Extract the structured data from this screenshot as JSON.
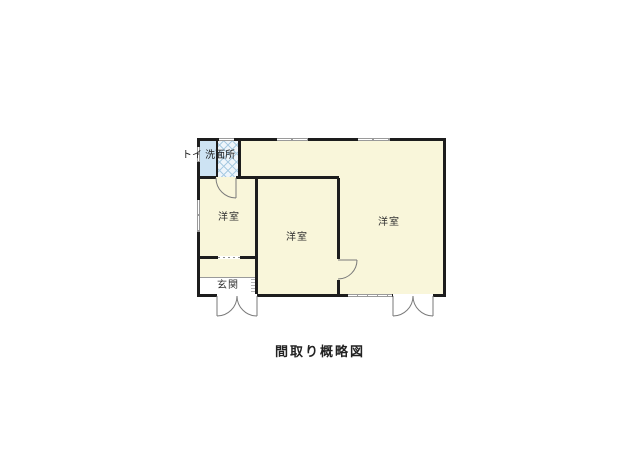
{
  "floor_plan": {
    "caption": "間取り概略図",
    "labels": {
      "toilet_washroom": "トイ 洗面所",
      "room_left": "洋室",
      "room_center": "洋室",
      "room_right": "洋室",
      "entrance": "玄関"
    },
    "colors": {
      "floor": "#f9f6da",
      "toilet": "#cde3f3",
      "washroom_hatch": "#a9cbe2",
      "wall": "#1d1d1d",
      "window": "#9a9a9a",
      "entrance_floor": "#ffffff",
      "door_line": "#7a7a7a"
    }
  }
}
